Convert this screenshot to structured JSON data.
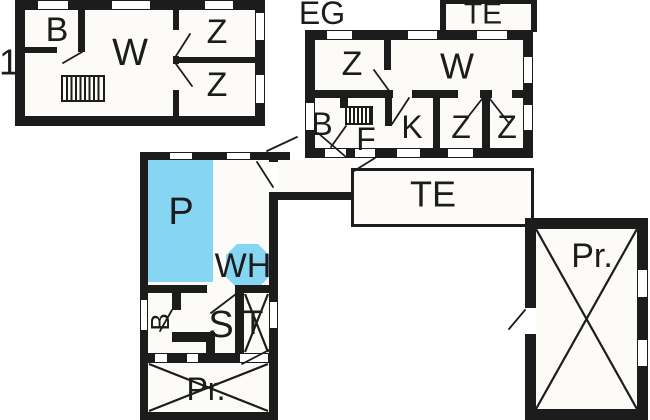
{
  "colors": {
    "wall": "#1c1c1c",
    "floor": "#fcfbf7",
    "pool": "#86d5f2",
    "paper": "#ffffff"
  },
  "upper_floor": {
    "floor_number": "1",
    "room_bath": "B",
    "room_living": "W",
    "room_z1": "Z",
    "room_z2": "Z"
  },
  "ground_floor": {
    "name": "EG",
    "terrace_top": "TE",
    "terrace_main": "TE",
    "room_z1": "Z",
    "room_living": "W",
    "room_bath": "B",
    "room_hall": "F",
    "room_kitchen": "K",
    "room_z2": "Z",
    "room_z3": "Z"
  },
  "pool_house": {
    "room_pool": "P",
    "room_whirlpool": "WH",
    "room_bath": "B",
    "room_sauna": "S",
    "room_technic": "T",
    "room_pr": "Pr."
  },
  "outbuilding": {
    "room_pr": "Pr."
  }
}
